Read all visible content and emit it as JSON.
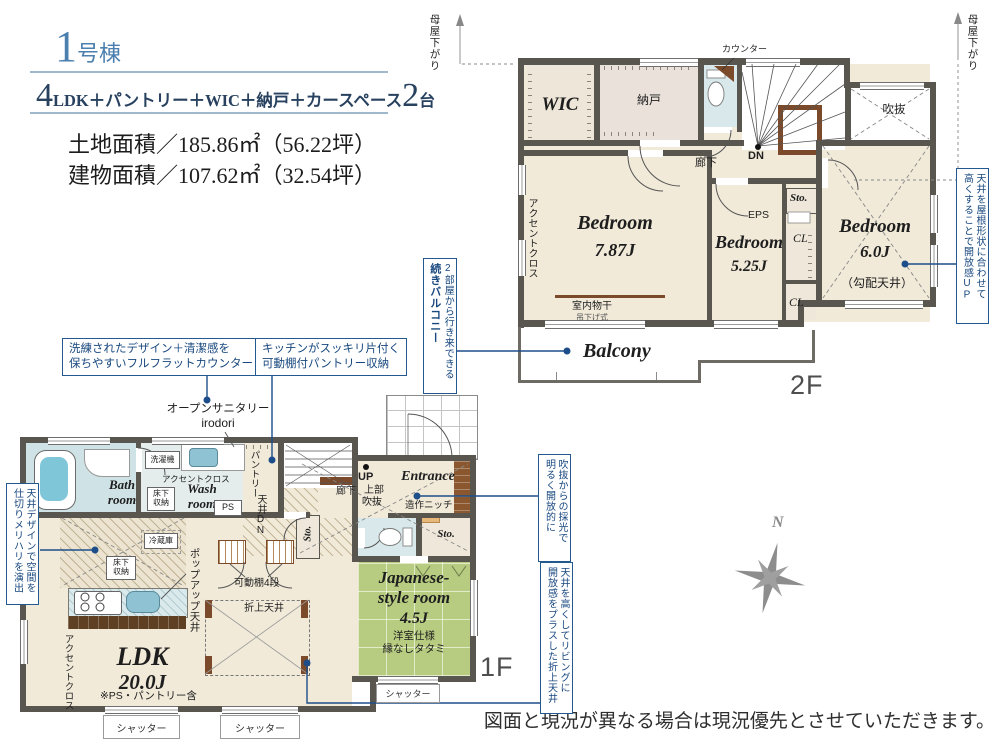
{
  "colors": {
    "title_blue": "#4a7fae",
    "spec_navy": "#27415f",
    "callout_blue": "#24598f",
    "leader_blue": "#1d4e8a",
    "wall_gray": "#59564f",
    "room_beige": "#f1ead9",
    "bath_blue": "#cfe2e5",
    "tatami_green": "#b7cc80",
    "wood_brown": "#7a4a2a",
    "floor_label_gray": "#4e4e4e"
  },
  "header": {
    "building_num": "1",
    "building_unit": "号棟",
    "spec_num_rooms": "4",
    "spec_rooms": "LDK＋パントリー＋WIC＋納戸＋カースペース",
    "spec_num_cars": "2",
    "spec_cars_unit": "台",
    "land_area": "土地面積／185.86㎡（56.22坪）",
    "building_area": "建物面積／107.62㎡（32.54坪）"
  },
  "floor2": {
    "floor_label": "2F",
    "moya_left": "母屋下がり",
    "moya_right": "母屋下がり",
    "counter": "カウンター",
    "wic": "WIC",
    "nando": "納戸",
    "dn": "DN",
    "hallway": "廊下",
    "void_label": "吹抜",
    "sto": "Sto.",
    "eps": "EPS",
    "cl_upper": "CL",
    "cl_lower": "CL",
    "accent_cloth": "アクセントクロス",
    "bedroom1": {
      "name": "Bedroom",
      "size": "7.87J"
    },
    "bedroom2": {
      "name": "Bedroom",
      "size": "5.25J"
    },
    "bedroom3": {
      "name": "Bedroom",
      "size": "6.0J",
      "note": "（勾配天井）"
    },
    "monohoshi": "室内物干",
    "monohoshi_sub": "吊下げ式",
    "balcony": "Balcony",
    "callout_balcony": {
      "col_right": "2部屋から行き来できる",
      "col_left": "続きバルコニー"
    },
    "callout_ceiling": {
      "col_right": "天井を屋根形状に合わせて",
      "col_left": "高くすることで開放感UP"
    }
  },
  "floor1": {
    "floor_label": "1F",
    "callout_counter": {
      "line1": "洗練されたデザイン＋清潔感を",
      "line2": "保ちやすいフルフラットカウンター"
    },
    "callout_pantry": {
      "line1": "キッチンがスッキリ片付く",
      "line2": "可動棚付パントリー収納"
    },
    "open_sanitary": "オープンサニタリー",
    "open_sanitary_brand": "irodori",
    "bath": {
      "name1": "Bath",
      "name2": "room"
    },
    "wash": {
      "name1": "Wash",
      "name2": "room"
    },
    "washer": "洗濯機",
    "accent_wash": "アクセントクロス",
    "floor_storage_wash": {
      "line1": "床下",
      "line2": "収納"
    },
    "ps": "PS",
    "pantry": "パントリー",
    "ceiling_dn": "天井DN",
    "fridge": "冷蔵庫",
    "floor_storage_kitchen": {
      "line1": "床下",
      "line2": "収納"
    },
    "popup_ceiling": "ポップアップ天井",
    "movable_shelf": "可動棚4段",
    "coffered_ceiling": "折上天井",
    "ldk": {
      "name": "LDK",
      "size": "20.0J",
      "note": "※PS・パントリー含"
    },
    "accent_ldk": "アクセントクロス",
    "up": "UP",
    "hallway": "廊下",
    "upper": "上部",
    "void_label": "吹抜",
    "entrance": "Entrance",
    "niche": "造作ニッチ",
    "sto_left": "Sto.",
    "sto_right": "Sto.",
    "jroom": {
      "name1": "Japanese-",
      "name2": "style room",
      "size": "4.5J",
      "note1": "洋室仕様",
      "note2": "縁なしタタミ"
    },
    "shutter1": "シャッター",
    "shutter2": "シャッター",
    "shutter3": "シャッター",
    "callout_left": {
      "col_right": "天井デザインで空間を",
      "col_left": "仕切りメリハリを演出"
    },
    "callout_void": {
      "col_right": "吹抜からの採光で",
      "col_left": "明るく開放的に"
    },
    "callout_oriage": {
      "col_right": "天井を高くしてリビングに",
      "col_left": "開放感をプラスした折上天井"
    }
  },
  "compass": {
    "north": "N"
  },
  "disclaimer": "図面と現況が異なる場合は現況優先とさせていただきます。"
}
